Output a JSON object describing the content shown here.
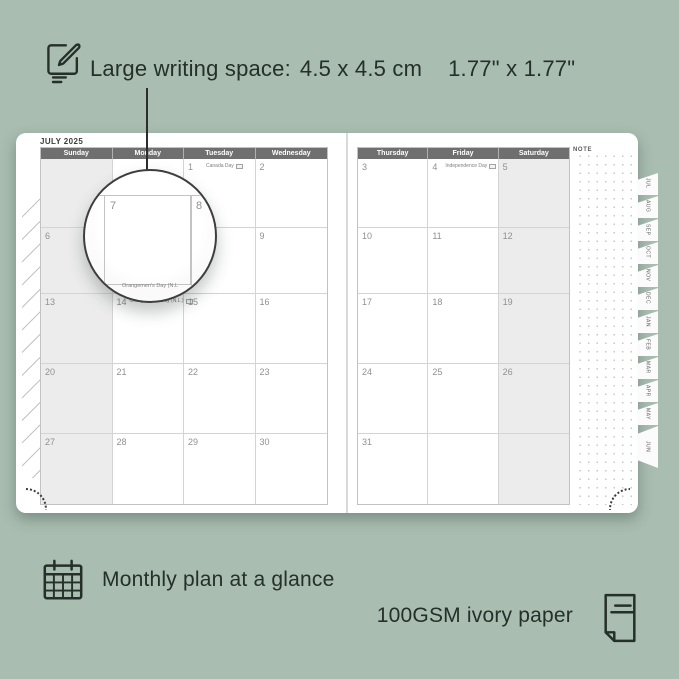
{
  "colors": {
    "background": "#a9bdb1",
    "ink": "#243029",
    "page": "#ffffff",
    "header_bar": "#6e6f6e",
    "weekend_shade": "#ececec",
    "grid_line": "#d4d4d4",
    "date_number": "#8f9090"
  },
  "annotations": {
    "writing_space": {
      "label": "Large writing space:",
      "cm": "4.5 x 4.5 cm",
      "inch": "1.77\" x 1.77\""
    },
    "monthly_plan": "Monthly plan at a glance",
    "paper": "100GSM ivory paper"
  },
  "planner": {
    "month_title": "JULY 2025",
    "note_label": "NOTE",
    "left_day_headers": [
      "Sunday",
      "Monday",
      "Tuesday",
      "Wednesday"
    ],
    "right_day_headers": [
      "Thursday",
      "Friday",
      "Saturday"
    ],
    "holidays": {
      "canada": "Canada Day",
      "orangemen": "Orangemen's Day (N.L.)",
      "independence": "Independence Day"
    },
    "left_dates": [
      [
        "",
        "",
        "1",
        "2"
      ],
      [
        "6",
        "7",
        "8",
        "9"
      ],
      [
        "13",
        "14",
        "15",
        "16"
      ],
      [
        "20",
        "21",
        "22",
        "23"
      ],
      [
        "27",
        "28",
        "29",
        "30"
      ]
    ],
    "right_dates": [
      [
        "3",
        "4",
        "5"
      ],
      [
        "10",
        "11",
        "12"
      ],
      [
        "17",
        "18",
        "19"
      ],
      [
        "24",
        "25",
        "26"
      ],
      [
        "31",
        "",
        ""
      ]
    ],
    "month_tabs": [
      "JUL",
      "AUG",
      "SEP",
      "OCT",
      "NOV",
      "DEC",
      "JAN",
      "FEB",
      "MAR",
      "APR",
      "MAY",
      "JUN"
    ],
    "magnifier": {
      "left_date": "7",
      "right_date": "8",
      "caption": "Orangemen's Day (N.L"
    }
  }
}
